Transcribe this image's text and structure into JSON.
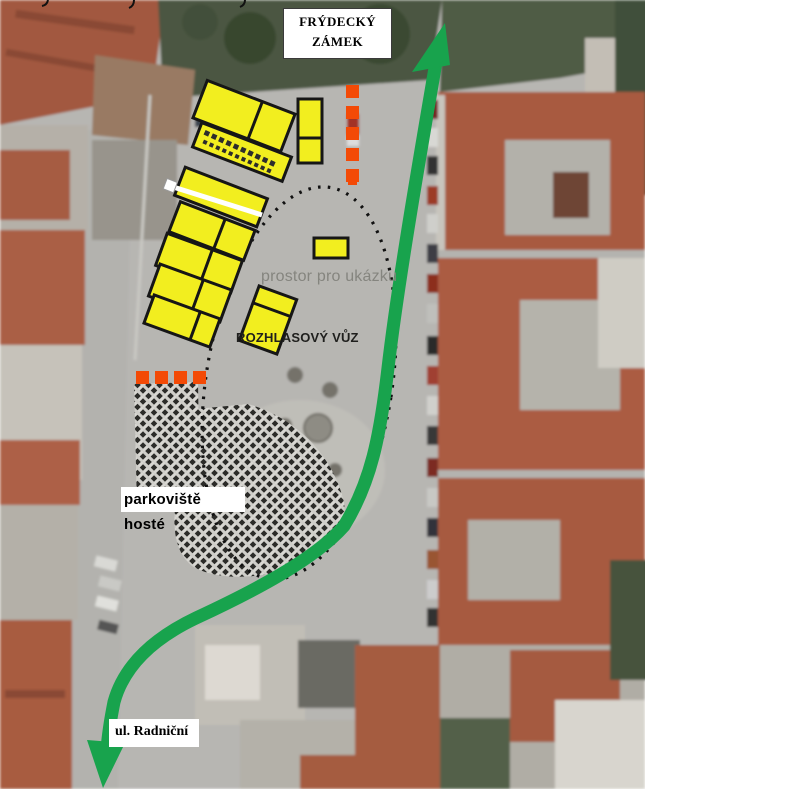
{
  "page": {
    "background": "#ffffff"
  },
  "overlay": {
    "castle_label": "FRÝDECKÝ\nZÁMEK",
    "demo_area_label": "prostor pro ukázku",
    "radio_van_label": "ROZHLASOVÝ VŮZ",
    "guest_parking_label": "parkoviště hosté",
    "street_label": "ul. Radniční"
  },
  "colors": {
    "stall_yellow": "#f2ee1f",
    "stall_border": "#161616",
    "route_green": "#18a34d",
    "barrier_orange": "#f34a06",
    "demo_text_gray": "#85857f",
    "plaza_gray": "#b7b6b2",
    "roof_orange": "#a85a41"
  },
  "annotations": {
    "stall_count": 10,
    "vertical_barrier_dashes": 5,
    "horizontal_barrier_dashes": 4,
    "route_style": "double-headed arrow",
    "demo_area_outline": "dotted ellipse",
    "guest_parking_pattern": "crosshatch"
  }
}
